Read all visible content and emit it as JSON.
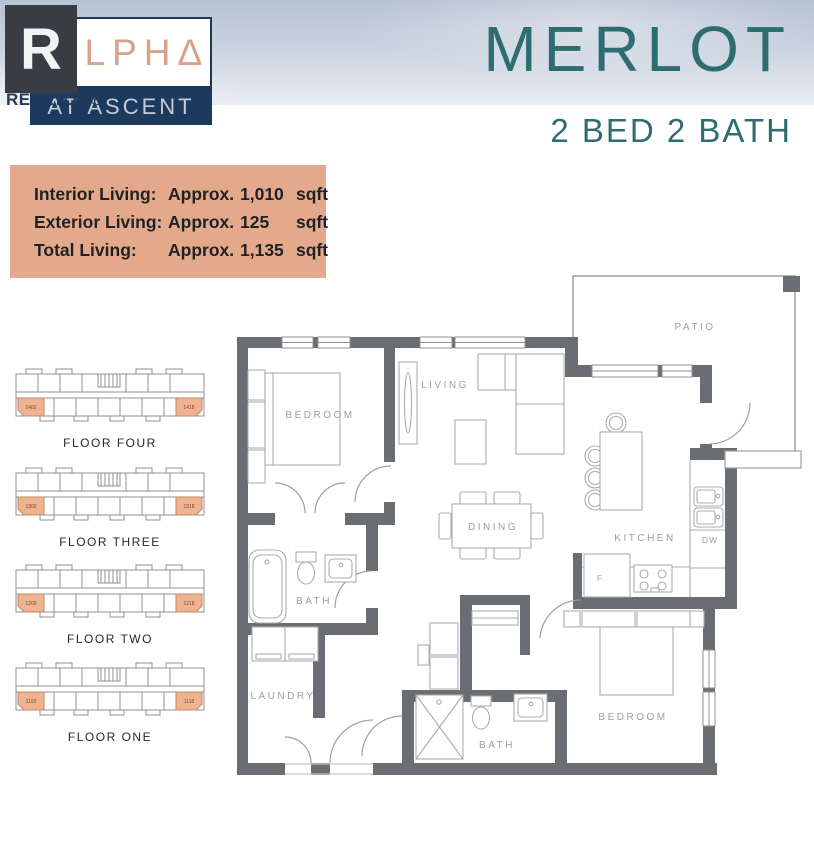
{
  "header": {
    "logo": {
      "r_glyph": "R",
      "brand": "ΛLPHΔ",
      "sub": "AT ASCENT",
      "realtor": "REALTOR®"
    },
    "title": "MERLOT",
    "subtitle": "2 BED 2 BATH"
  },
  "info_box": {
    "rows": [
      {
        "label": "Interior Living:",
        "approx": "Approx.",
        "value": "1,010",
        "unit": "sqft"
      },
      {
        "label": "Exterior Living:",
        "approx": "Approx.",
        "value": "125",
        "unit": "sqft"
      },
      {
        "label": "Total Living:",
        "approx": "Approx.",
        "value": "1,135",
        "unit": "sqft"
      }
    ]
  },
  "floors": [
    {
      "name": "FLOOR FOUR",
      "left_unit": "1402",
      "right_unit": "1418"
    },
    {
      "name": "FLOOR THREE",
      "left_unit": "1302",
      "right_unit": "1318"
    },
    {
      "name": "FLOOR TWO",
      "left_unit": "1202",
      "right_unit": "1218"
    },
    {
      "name": "FLOOR ONE",
      "left_unit": "1102",
      "right_unit": "1118"
    }
  ],
  "plan": {
    "labels": {
      "patio": "PATIO",
      "living": "LIVING",
      "bedroom1": "BEDROOM",
      "dining": "DINING",
      "kitchen": "KITCHEN",
      "dw": "DW",
      "fridge": "F",
      "bath1": "BATH",
      "laundry": "LAUNDRY",
      "bath2": "BATH",
      "bedroom2": "BEDROOM"
    }
  },
  "colors": {
    "teal": "#2d6d70",
    "navy": "#1c3a5e",
    "salmon": "#d7a28b",
    "peach_box": "#e4a98a",
    "unit_highlight": "#f0b391",
    "wall_gray": "#6a6e73"
  }
}
